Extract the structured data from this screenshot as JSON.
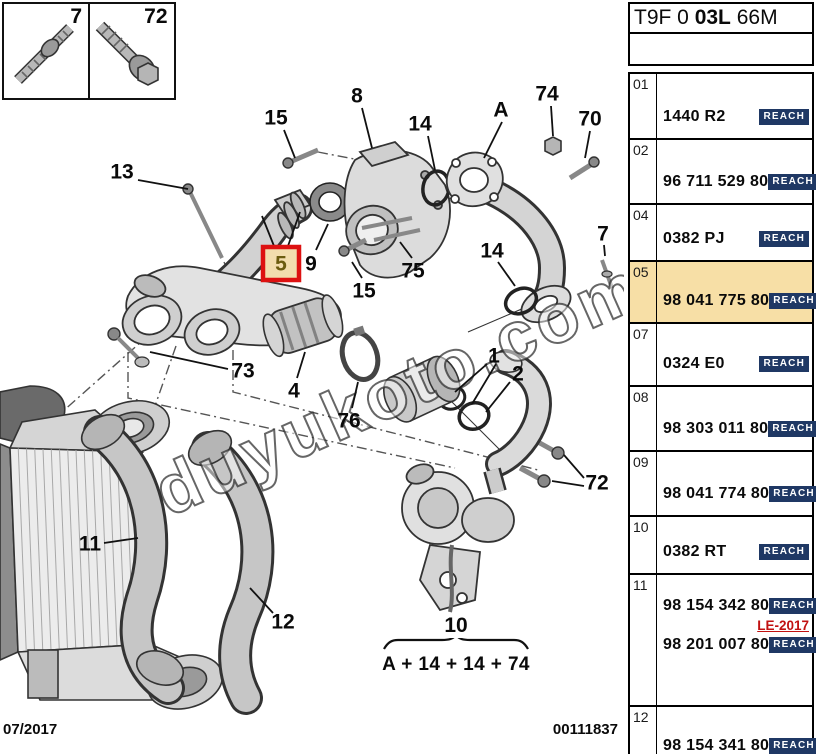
{
  "header": {
    "code_prefix": "T9F 0 ",
    "code_bold": "03L",
    "code_suffix": " 66M"
  },
  "inset_parts": [
    {
      "label": "7"
    },
    {
      "label": "72"
    }
  ],
  "watermark": {
    "text": "duyukoto.com"
  },
  "formula": {
    "result": "10",
    "expression": "A + 14 + 14 + 74"
  },
  "footer": {
    "date": "07/2017",
    "doc_number": "00111837"
  },
  "colors": {
    "highlight_bg": "#f7dfa6",
    "badge_bg": "#1f3864",
    "note_red": "#c11111",
    "callout_box_red": "#dd1111",
    "callout_box_fill": "#f2ddae",
    "callout_box_text": "#6b5c10"
  },
  "diagram": {
    "callouts": [
      {
        "label": "13",
        "x": 122,
        "y": 172,
        "leaders": [
          [
            138,
            180,
            188,
            189
          ]
        ]
      },
      {
        "label": "15",
        "x": 276,
        "y": 118,
        "leaders": [
          [
            284,
            130,
            295,
            158
          ]
        ]
      },
      {
        "label": "8",
        "x": 357,
        "y": 96,
        "leaders": [
          [
            362,
            108,
            372,
            148
          ]
        ]
      },
      {
        "label": "14",
        "x": 420,
        "y": 124,
        "leaders": [
          [
            428,
            136,
            435,
            170
          ]
        ]
      },
      {
        "label": "A",
        "x": 501,
        "y": 110,
        "leaders": [
          [
            502,
            122,
            484,
            158
          ]
        ]
      },
      {
        "label": "74",
        "x": 547,
        "y": 94,
        "leaders": [
          [
            551,
            106,
            553,
            136
          ]
        ]
      },
      {
        "label": "70",
        "x": 590,
        "y": 119,
        "leaders": [
          [
            590,
            131,
            585,
            158
          ]
        ]
      },
      {
        "label": "5",
        "x": 281,
        "y": 264,
        "boxed": true,
        "leaders": [
          [
            274,
            246,
            262,
            216
          ],
          [
            288,
            246,
            300,
            212
          ]
        ]
      },
      {
        "label": "9",
        "x": 311,
        "y": 264,
        "leaders": [
          [
            316,
            250,
            328,
            224
          ]
        ]
      },
      {
        "label": "75",
        "x": 413,
        "y": 271,
        "leaders": [
          [
            412,
            258,
            400,
            242
          ]
        ]
      },
      {
        "label": "15",
        "x": 364,
        "y": 291,
        "leaders": [
          [
            362,
            278,
            352,
            262
          ]
        ]
      },
      {
        "label": "14",
        "x": 492,
        "y": 251,
        "leaders": [
          [
            498,
            262,
            515,
            286
          ]
        ]
      },
      {
        "label": "7",
        "x": 603,
        "y": 234,
        "leaders": [
          [
            604,
            245,
            605,
            256
          ]
        ]
      },
      {
        "label": "73",
        "x": 243,
        "y": 371,
        "leaders": [
          [
            228,
            369,
            150,
            352
          ]
        ]
      },
      {
        "label": "4",
        "x": 294,
        "y": 391,
        "leaders": [
          [
            297,
            378,
            305,
            352
          ]
        ]
      },
      {
        "label": "76",
        "x": 349,
        "y": 421,
        "leaders": [
          [
            352,
            408,
            358,
            382
          ]
        ]
      },
      {
        "label": "1",
        "x": 494,
        "y": 356,
        "leaders": [
          [
            487,
            364,
            455,
            392
          ],
          [
            496,
            364,
            472,
            404
          ]
        ]
      },
      {
        "label": "2",
        "x": 518,
        "y": 374,
        "leaders": [
          [
            510,
            382,
            486,
            412
          ]
        ]
      },
      {
        "label": "72",
        "x": 597,
        "y": 483,
        "leaders": [
          [
            584,
            478,
            564,
            455
          ],
          [
            584,
            486,
            552,
            481
          ]
        ]
      },
      {
        "label": "11",
        "x": 90,
        "y": 544,
        "leaders": [
          [
            104,
            543,
            138,
            538
          ]
        ]
      },
      {
        "label": "12",
        "x": 283,
        "y": 622,
        "leaders": [
          [
            273,
            613,
            250,
            588
          ]
        ]
      }
    ]
  },
  "table": {
    "rows": [
      {
        "num": "01",
        "parts": [
          {
            "pn": "1440 R2",
            "badge": "REACH"
          }
        ]
      },
      {
        "num": "02",
        "parts": [
          {
            "pn": "96 711 529 80",
            "badge": "REACH"
          }
        ]
      },
      {
        "num": "04",
        "parts": [
          {
            "pn": "0382 PJ",
            "badge": "REACH"
          }
        ]
      },
      {
        "num": "05",
        "parts": [
          {
            "pn": "98 041 775 80",
            "badge": "REACH"
          }
        ],
        "highlight": true
      },
      {
        "num": "07",
        "parts": [
          {
            "pn": "0324 E0",
            "badge": "REACH"
          }
        ]
      },
      {
        "num": "08",
        "parts": [
          {
            "pn": "98 303 011 80",
            "badge": "REACH"
          }
        ]
      },
      {
        "num": "09",
        "parts": [
          {
            "pn": "98 041 774 80",
            "badge": "REACH"
          }
        ]
      },
      {
        "num": "10",
        "parts": [
          {
            "pn": "0382 RT",
            "badge": "REACH"
          }
        ]
      },
      {
        "num": "11",
        "parts": [
          {
            "pn": "98 154 342 80",
            "badge": "REACH"
          },
          {
            "pn": "98 201 007 80",
            "badge": "REACH"
          }
        ],
        "note": "LE-2017"
      },
      {
        "num": "12",
        "parts": [
          {
            "pn": "98 154 341 80",
            "badge": "REACH"
          }
        ]
      }
    ]
  }
}
